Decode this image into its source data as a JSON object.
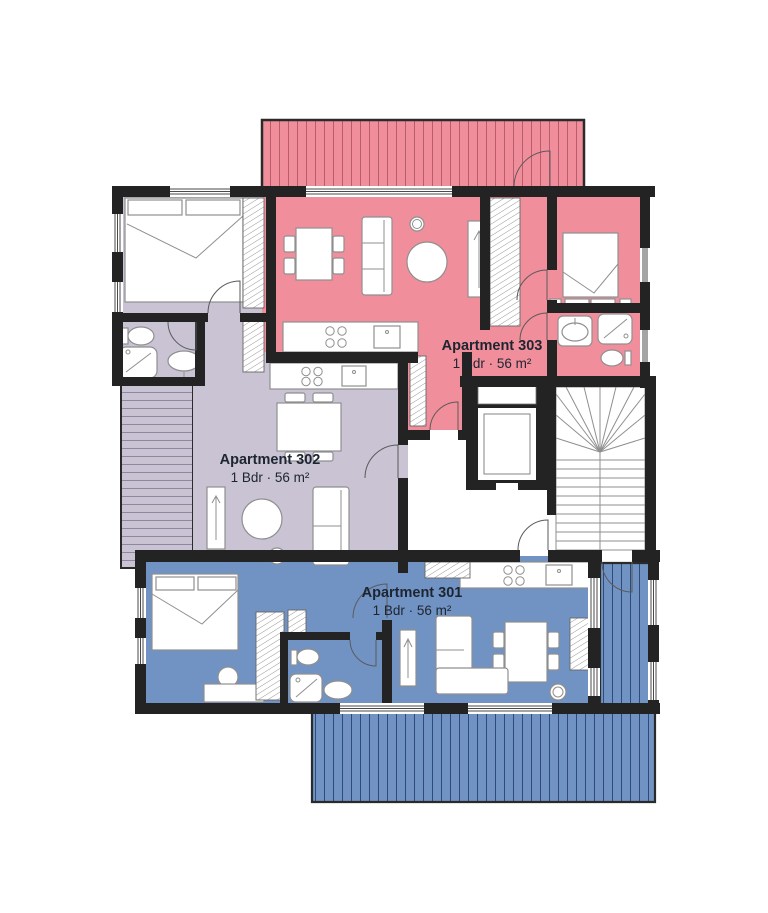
{
  "floor_plan": {
    "apartments": [
      {
        "id": "301",
        "name": "Apartment 301",
        "spec": "1 Bdr · 56 m²",
        "color": "#7193c4",
        "terrace_stripe": "#2e4a78"
      },
      {
        "id": "302",
        "name": "Apartment 302",
        "spec": "1 Bdr · 56 m²",
        "color": "#c9c3d4",
        "terrace_stripe": "#8d87a0"
      },
      {
        "id": "303",
        "name": "Apartment 303",
        "spec": "1 Bdr · 56 m²",
        "color": "#f18e9b",
        "terrace_stripe": "#b85d6c"
      }
    ],
    "colors": {
      "wall": "#232323",
      "background": "#ffffff",
      "furniture_line": "#8f8f8f",
      "door_line": "#5a5a5a",
      "label": "#1d2531"
    }
  }
}
